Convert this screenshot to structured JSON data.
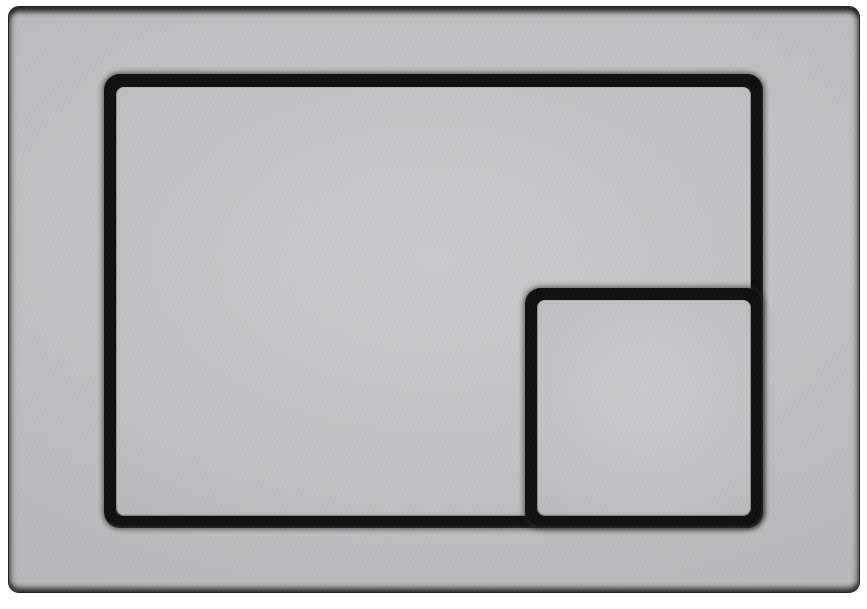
{
  "scene": {
    "kind": "product-photo",
    "subject": "dual-flush-actuator-plate"
  },
  "colors": {
    "canvas-bg": "#ffffff",
    "plate-base": "#bcbcbe",
    "plate-light": "#c7c7c9",
    "plate-dark": "#aeaeb0",
    "button-base": "#bfbfc1",
    "button-light": "#cacacc",
    "button-dark": "#b2b2b4",
    "groove-black": "#101010",
    "edge-dark": "#232323"
  },
  "components": {
    "plate": "flush-plate",
    "large_button": "large-flush-button",
    "small_button": "small-flush-button"
  }
}
